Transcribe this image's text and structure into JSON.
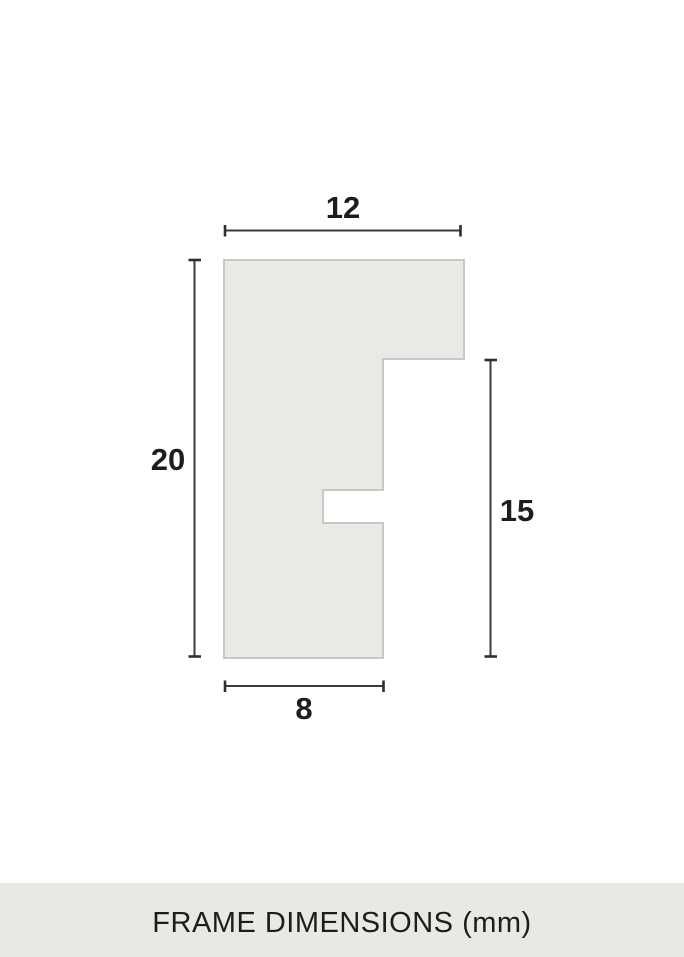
{
  "diagram": {
    "profile": {
      "polygon_points": "224,260 464,260 464,359 383,359 383,490 323,490 323,523 383,523 383,658 224,658",
      "fill_color": "#e9eae5",
      "stroke_color": "#c8c9c4"
    },
    "dimensions": {
      "top_width": "12",
      "left_height": "20",
      "right_height": "15",
      "bottom_width": "8"
    },
    "dimension_line_color": "#3a3a3a",
    "label_color": "#1d1d1b"
  },
  "caption": {
    "text": "FRAME DIMENSIONS (mm)",
    "background_color": "#e8e9e4"
  }
}
